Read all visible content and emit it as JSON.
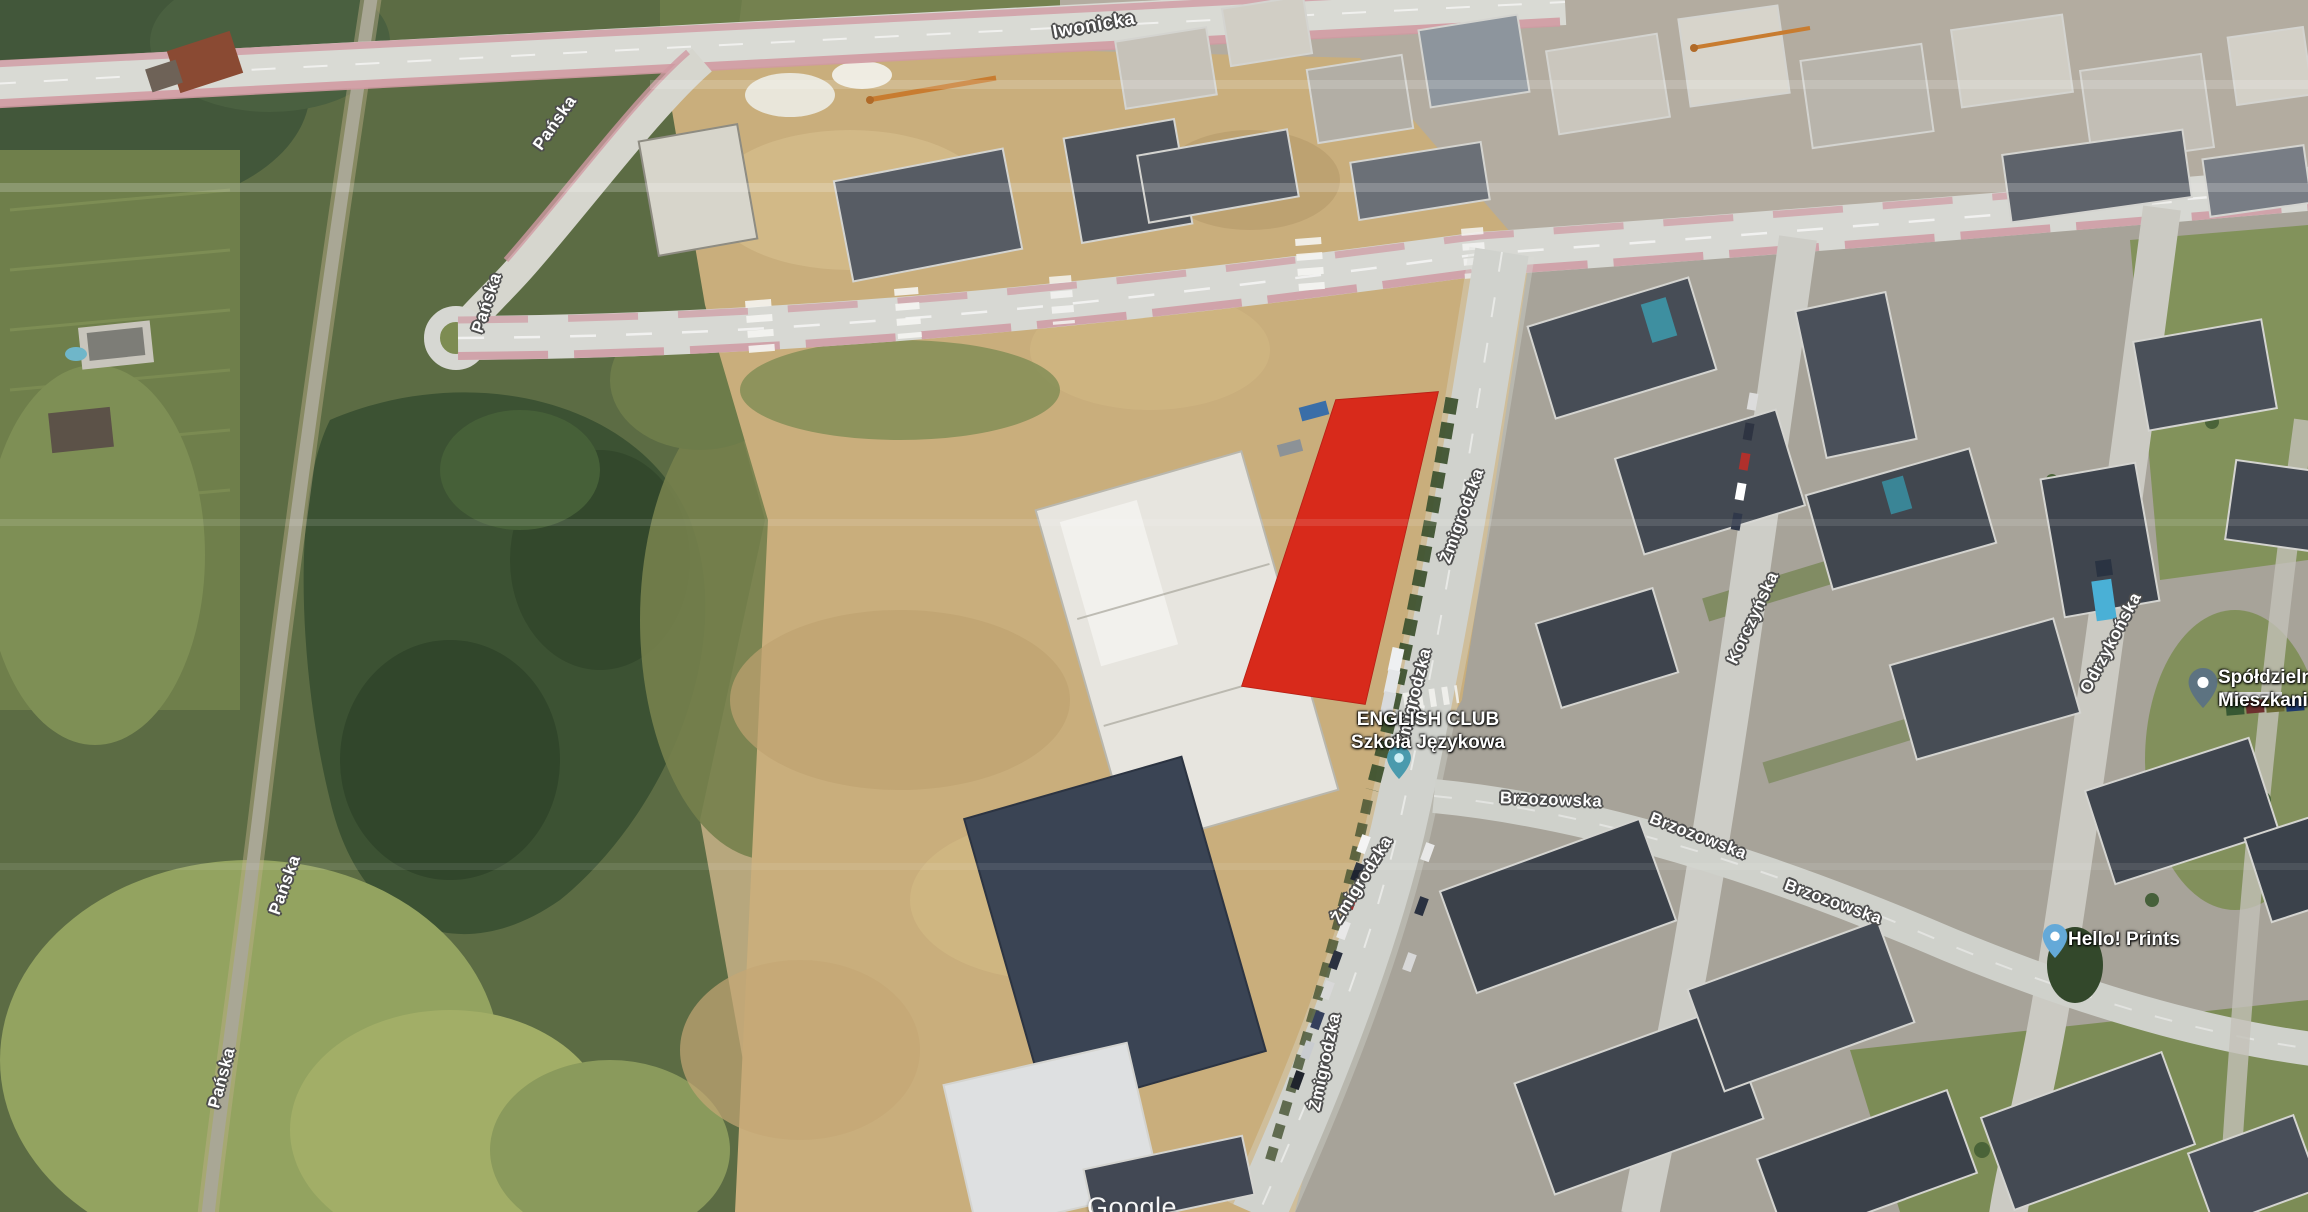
{
  "map": {
    "view_type": "satellite",
    "provider_watermark": "Google",
    "street_labels": [
      {
        "text": "Iwonicka",
        "x": 1094,
        "y": 26,
        "rotate": -10
      },
      {
        "text": "Pańska",
        "x": 555,
        "y": 123,
        "rotate": -55
      },
      {
        "text": "Pańska",
        "x": 487,
        "y": 303,
        "rotate": -72
      },
      {
        "text": "Pańska",
        "x": 285,
        "y": 885,
        "rotate": -70
      },
      {
        "text": "Pańska",
        "x": 222,
        "y": 1078,
        "rotate": -75
      },
      {
        "text": "Żmigrodzka",
        "x": 1462,
        "y": 516,
        "rotate": -70
      },
      {
        "text": "Żmigrodzka",
        "x": 1414,
        "y": 697,
        "rotate": -76
      },
      {
        "text": "Żmigrodzka",
        "x": 1362,
        "y": 880,
        "rotate": -58
      },
      {
        "text": "Żmigrodzka",
        "x": 1325,
        "y": 1062,
        "rotate": -78
      },
      {
        "text": "Korczyńska",
        "x": 1753,
        "y": 618,
        "rotate": -65
      },
      {
        "text": "Brzozowska",
        "x": 1551,
        "y": 800,
        "rotate": 2
      },
      {
        "text": "Brzozowska",
        "x": 1698,
        "y": 836,
        "rotate": 21
      },
      {
        "text": "Brzozowska",
        "x": 1833,
        "y": 902,
        "rotate": 20
      },
      {
        "text": "Odrzykońska",
        "x": 2111,
        "y": 643,
        "rotate": -62
      }
    ],
    "pois": [
      {
        "title": "ENGLISH CLUB",
        "subtitle": "Szkoła Językowa",
        "pin_color": "#4a9aad",
        "pin_inner": "#cdeef5"
      },
      {
        "title": "Spółdzielnia",
        "subtitle": "Mieszkaniowa",
        "pin_color": "#5d7381",
        "pin_inner": "#ffffff"
      },
      {
        "title": "Hello! Prints",
        "pin_color": "#64a9d8",
        "pin_inner": "#ffffff"
      }
    ],
    "highlight": {
      "points": "1336,400 1438,392 1365,704 1242,686",
      "color": "#d8291b",
      "fill_opacity": "0.94"
    }
  }
}
